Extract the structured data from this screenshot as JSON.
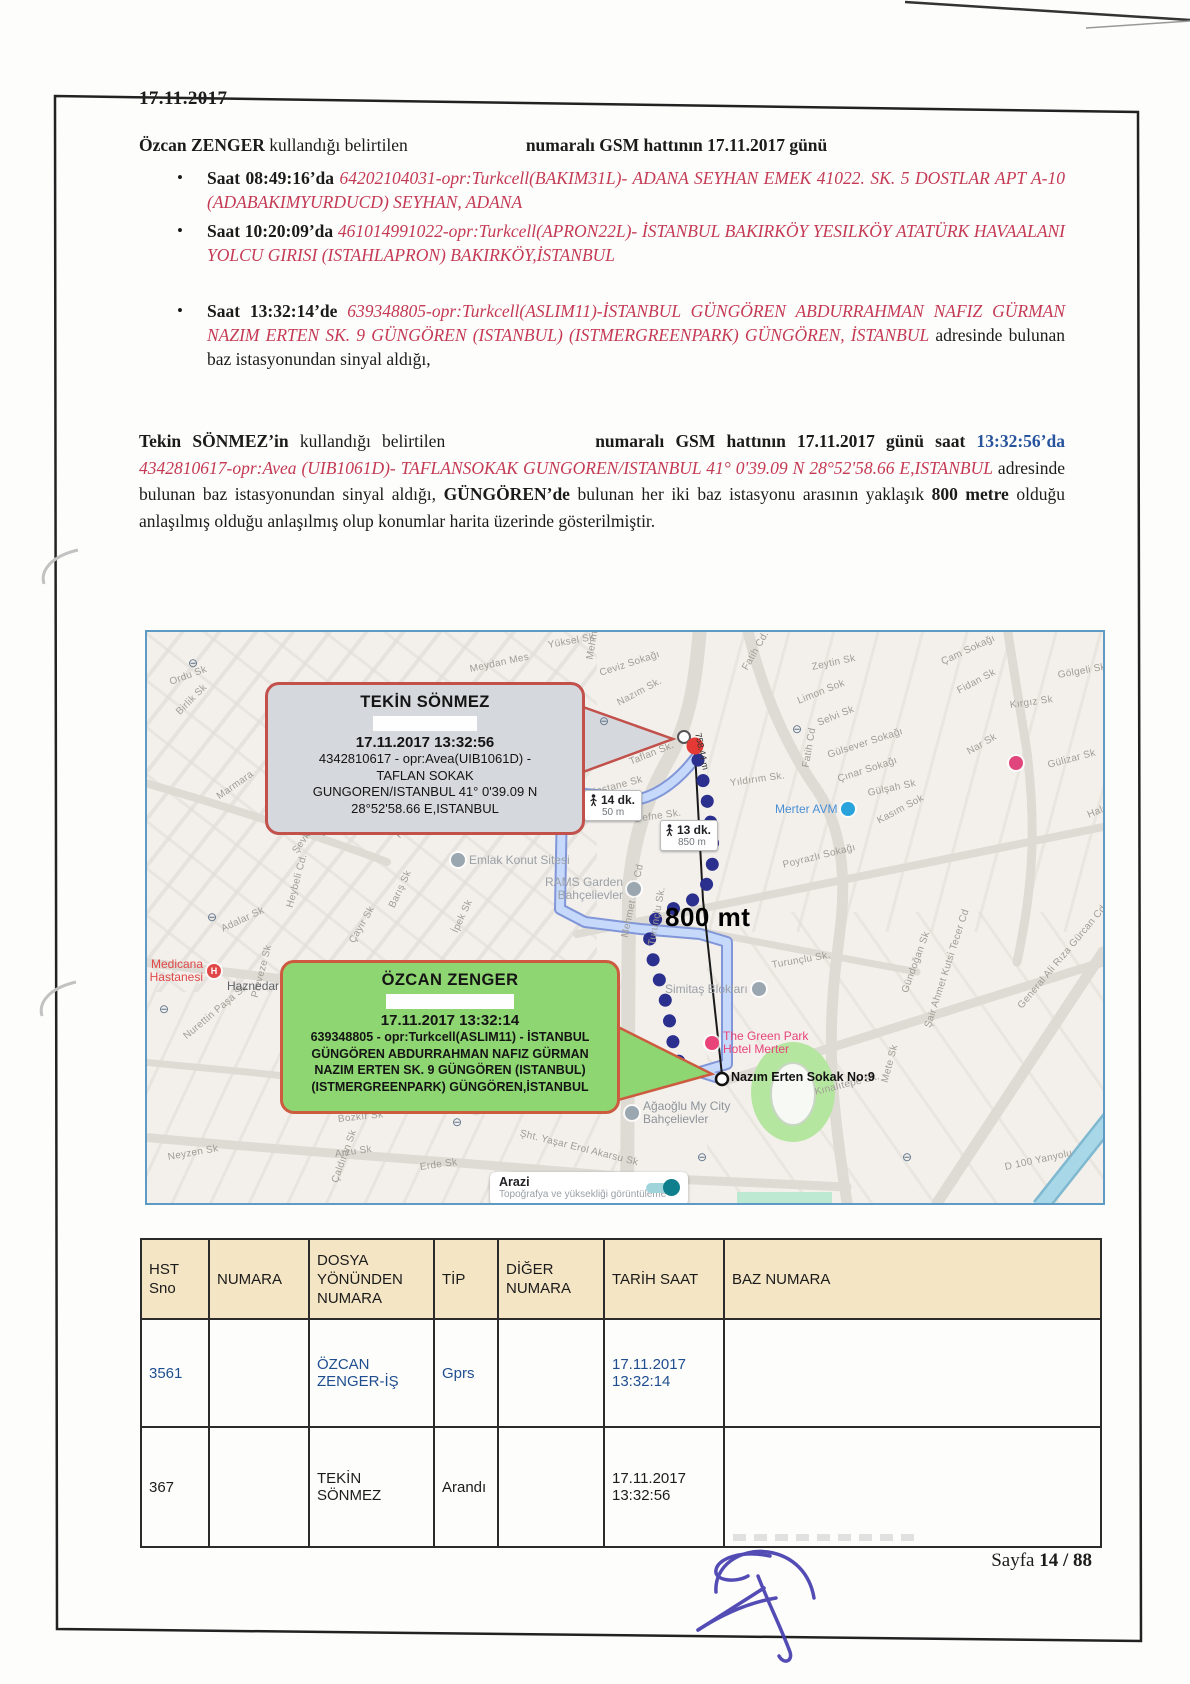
{
  "page": {
    "date": "17.11.2017",
    "footer_prefix": "Sayfa ",
    "footer_page": "14 / 88"
  },
  "ozcan_para": {
    "name": "Özcan ZENGER",
    "mid": " kullandığı belirtilen",
    "tail": "numaralı GSM hattının 17.11.2017 günü"
  },
  "bullets": [
    {
      "time": "Saat 08:49:16’da ",
      "detail": "64202104031-opr:Turkcell(BAKIM31L)- ADANA SEYHAN EMEK 41022. SK. 5 DOSTLAR APT A-10 (ADABAKIMYURDUCD) SEYHAN, ADANA",
      "suffix": ""
    },
    {
      "time": "Saat 10:20:09’da ",
      "detail": "461014991022-opr:Turkcell(APRON22L)- İSTANBUL BAKIRKÖY YESILKÖY ATATÜRK HAVAALANI YOLCU GIRISI (ISTAHLAPRON) BAKIRKÖY,İSTANBUL",
      "suffix": ""
    },
    {
      "time": "Saat 13:32:14’de ",
      "detail": "639348805-opr:Turkcell(ASLIM11)-İSTANBUL GÜNGÖREN ABDURRAHMAN NAFIZ GÜRMAN NAZIM ERTEN SK. 9 GÜNGÖREN (ISTANBUL) (ISTMERGREENPARK) GÜNGÖREN, İSTANBUL",
      "suffix": " adresinde bulunan baz istasyonundan sinyal aldığı,"
    }
  ],
  "tekin_para": {
    "name": "Tekin SÖNMEZ’in",
    "mid": " kullandığı belirtilen",
    "bold1": "numaralı GSM hattının 17.11.2017 günü saat ",
    "time_blue": "13:32:56’da ",
    "red": "4342810617-opr:Avea (UIB1061D)- TAFLANSOKAK GUNGOREN/ISTANBUL 41° 0'39.09 N 28°52'58.66 E,ISTANBUL",
    "normal1": " adresinde bulunan baz istasyonundan sinyal aldığı, ",
    "bold2": "GÜNGÖREN’de",
    "normal2": " bulunan her iki baz istasyonu arasının yaklaşık ",
    "bold3": "800 metre",
    "normal3": " olduğu anlaşılmış olduğu anlaşılmış olup konumlar harita üzerinde gösterilmiştir."
  },
  "map": {
    "callouts": {
      "tekin": {
        "title": "TEKİN SÖNMEZ",
        "datetime": "17.11.2017 13:32:56",
        "line1": "4342810617 - opr:Avea(UIB1061D) -",
        "line2": "TAFLAN SOKAK",
        "line3": "GUNGOREN/ISTANBUL   41° 0'39.09 N",
        "line4": "28°52'58.66 E,ISTANBUL"
      },
      "ozcan": {
        "title": "ÖZCAN ZENGER",
        "datetime": "17.11.2017 13:32:14",
        "line1": "639348805 - opr:Turkcell(ASLIM11) - İSTANBUL",
        "line2": "GÜNGÖREN ABDURRAHMAN NAFIZ GÜRMAN",
        "line3": "NAZIM ERTEN SK. 9 GÜNGÖREN (ISTANBUL)",
        "line4": "(ISTMERGREENPARK) GÜNGÖREN,İSTANBUL"
      }
    },
    "distance_big": "800 mt",
    "measure_label": "758.44 m",
    "route_badge_1": {
      "duration": "13 dk.",
      "distance": "850 m"
    },
    "route_badge_2": {
      "duration": "14 dk.",
      "distance": "50 m"
    },
    "destination_label": "Nazım Erten Sokak No:9",
    "terrain": {
      "title": "Arazi",
      "subtitle": "Topoğrafya ve yüksekliği görüntüleme"
    },
    "colors": {
      "route": "#2b2f8e",
      "route_light": "#c6d9fb",
      "marker_red": "#e53935",
      "callout_gray": "#d5d8dc",
      "callout_green": "#8ed672",
      "border_red": "#c2504b"
    },
    "pois": [
      {
        "t": "Merter AVM",
        "x": 628,
        "y": 170,
        "side": "r",
        "c": "#4a8fd4",
        "ic": "#29a3dc"
      },
      {
        "t": "Emlak Konut Sitesi",
        "x": 304,
        "y": 221,
        "side": "l",
        "c": "#9aa0a6",
        "ic": "#9aa7b0"
      },
      {
        "t": "RAMS Garden Bahçelievler",
        "x": 388,
        "y": 244,
        "side": "r",
        "c": "#9aa0a6",
        "ic": "#9aa7b0",
        "w": 88,
        "ta": "right"
      },
      {
        "t": "Simitaş Blokları",
        "x": 518,
        "y": 350,
        "side": "r",
        "c": "#9aa0a6",
        "ic": "#9aa7b0"
      },
      {
        "t": "The Green Park Hotel Merter",
        "x": 558,
        "y": 398,
        "side": "l",
        "c": "#e8447a",
        "ic": "#e8447a",
        "w": 112
      },
      {
        "t": "Ağaoğlu My City Bahçelievler",
        "x": 478,
        "y": 468,
        "side": "l",
        "c": "#8d9399",
        "ic": "#9aa7b0",
        "w": 118
      },
      {
        "t": "Medicana Hastanesi",
        "x": -14,
        "y": 326,
        "side": "r",
        "c": "#e04848",
        "ic": "#e04848",
        "letter": "H",
        "w": 70,
        "ta": "right"
      },
      {
        "t": "Haznedar",
        "x": 80,
        "y": 348,
        "side": "r",
        "c": "#5f6368",
        "ic": "#98a4ae",
        "sq": 1
      },
      {
        "t": "",
        "x": 862,
        "y": 124,
        "side": "l",
        "c": "#000000",
        "ic": "#e0457b"
      }
    ],
    "streets": [
      {
        "t": "Yüksel Sk",
        "x": 401,
        "y": 8,
        "r": -10
      },
      {
        "t": "Ceviz Sokağı",
        "x": 453,
        "y": 36,
        "r": -18
      },
      {
        "t": "Nazım Sk.",
        "x": 471,
        "y": 66,
        "r": -28
      },
      {
        "t": "Meydan Mes",
        "x": 323,
        "y": 32,
        "r": -12
      },
      {
        "t": "Mehmet Akif Cd",
        "x": 443,
        "y": 22,
        "r": -80
      },
      {
        "t": "Fatih Cd.",
        "x": 598,
        "y": 32,
        "r": -60
      },
      {
        "t": "Zeytin Sk",
        "x": 665,
        "y": 30,
        "r": -12
      },
      {
        "t": "Limon Sok",
        "x": 651,
        "y": 64,
        "r": -22
      },
      {
        "t": "Selvi Sk",
        "x": 671,
        "y": 86,
        "r": -22
      },
      {
        "t": "Gülsever Sokağı",
        "x": 681,
        "y": 118,
        "r": -18
      },
      {
        "t": "Çınar Sokağı",
        "x": 691,
        "y": 142,
        "r": -18
      },
      {
        "t": "Fatih Cd",
        "x": 659,
        "y": 130,
        "r": -80
      },
      {
        "t": "Gülşah Sk",
        "x": 721,
        "y": 156,
        "r": -12
      },
      {
        "t": "Kasım Sok",
        "x": 731,
        "y": 184,
        "r": -28
      },
      {
        "t": "Çam Sokağı",
        "x": 795,
        "y": 25,
        "r": -25
      },
      {
        "t": "Gölgeli Sk",
        "x": 911,
        "y": 38,
        "r": -10
      },
      {
        "t": "Fidan Sk",
        "x": 811,
        "y": 54,
        "r": -28
      },
      {
        "t": "Kırgız Sk",
        "x": 863,
        "y": 68,
        "r": -8
      },
      {
        "t": "Nar Sk",
        "x": 821,
        "y": 115,
        "r": -30
      },
      {
        "t": "Gülizar Sk",
        "x": 901,
        "y": 128,
        "r": -15
      },
      {
        "t": "Haldun Tan",
        "x": 941,
        "y": 178,
        "r": -22
      },
      {
        "t": "Taflan Sk.",
        "x": 483,
        "y": 125,
        "r": -22
      },
      {
        "t": "Kestane Sk",
        "x": 443,
        "y": 156,
        "r": -15
      },
      {
        "t": "Defne Sk.",
        "x": 488,
        "y": 182,
        "r": -8
      },
      {
        "t": "Yıldırım Sk.",
        "x": 583,
        "y": 146,
        "r": -8
      },
      {
        "t": "Poyrazlı Sokağı",
        "x": 636,
        "y": 228,
        "r": -14
      },
      {
        "t": "Ordu Sk",
        "x": 23,
        "y": 45,
        "r": -20
      },
      {
        "t": "Birlik Sk",
        "x": 31,
        "y": 76,
        "r": -45
      },
      {
        "t": "Marmara",
        "x": 71,
        "y": 160,
        "r": -35
      },
      {
        "t": "Ahmtar Sk",
        "x": 193,
        "y": 165,
        "r": -70
      },
      {
        "t": "Köşkler Sk",
        "x": 175,
        "y": 198,
        "r": -55
      },
      {
        "t": "Şevket Dağ Cd.",
        "x": 148,
        "y": 215,
        "r": -55
      },
      {
        "t": "Adnan Kahveci Blv",
        "x": 251,
        "y": 200,
        "r": -72
      },
      {
        "t": "Barış Sk",
        "x": 245,
        "y": 270,
        "r": -65
      },
      {
        "t": "İpek Sk",
        "x": 308,
        "y": 295,
        "r": -65
      },
      {
        "t": "Çayır Sk",
        "x": 205,
        "y": 305,
        "r": -60
      },
      {
        "t": "Heybeli Cd.",
        "x": 143,
        "y": 270,
        "r": -75
      },
      {
        "t": "Adalar Sk",
        "x": 75,
        "y": 292,
        "r": -25
      },
      {
        "t": "Preveze Sk",
        "x": 108,
        "y": 360,
        "r": -75
      },
      {
        "t": "Nurettin Paşa Sk",
        "x": 38,
        "y": 400,
        "r": -40
      },
      {
        "t": "Mehmet Akif Cd",
        "x": 478,
        "y": 300,
        "r": -78
      },
      {
        "t": "Turunçlu Sk.",
        "x": 505,
        "y": 308,
        "r": -80
      },
      {
        "t": "Turunçlu Sk.",
        "x": 625,
        "y": 328,
        "r": -10
      },
      {
        "t": "Bozkır Sk",
        "x": 191,
        "y": 482,
        "r": -6
      },
      {
        "t": "Arzu Sk",
        "x": 188,
        "y": 517,
        "r": -8
      },
      {
        "t": "Şht. Yaşar Erol Akarsu Sk",
        "x": 373,
        "y": 496,
        "r": 14
      },
      {
        "t": "Kınalıtepe Sk.",
        "x": 668,
        "y": 455,
        "r": -14
      },
      {
        "t": "Gündoğan Sk",
        "x": 758,
        "y": 355,
        "r": -70
      },
      {
        "t": "Şair Ahmet Kutsi Tecer Cd",
        "x": 781,
        "y": 390,
        "r": -72
      },
      {
        "t": "General Ali Rıza Gürcan Cd.",
        "x": 873,
        "y": 370,
        "r": -50
      },
      {
        "t": "Mete Sk",
        "x": 738,
        "y": 445,
        "r": -75
      },
      {
        "t": "D 100 Yanyolu",
        "x": 858,
        "y": 530,
        "r": -12
      },
      {
        "t": "Erde Sk",
        "x": 273,
        "y": 530,
        "r": -8
      },
      {
        "t": "Neyzen Sk",
        "x": 21,
        "y": 520,
        "r": -10
      },
      {
        "t": "Çaldıran Sk",
        "x": 188,
        "y": 545,
        "r": -70
      }
    ],
    "transit": [
      [
        41,
        24
      ],
      [
        452,
        82
      ],
      [
        645,
        90
      ],
      [
        60,
        278
      ],
      [
        12,
        370
      ],
      [
        305,
        483
      ],
      [
        550,
        518
      ],
      [
        755,
        518
      ]
    ]
  },
  "table": {
    "headers": [
      "HST Sno",
      "NUMARA",
      "DOSYA YÖNÜNDEN NUMARA",
      "TİP",
      "DİĞER NUMARA",
      "TARİH SAAT",
      "BAZ NUMARA"
    ],
    "rows": [
      {
        "hst": "3561",
        "numara": "",
        "dosya": "ÖZCAN ZENGER-İŞ",
        "tip": "Gprs",
        "diger": "",
        "tarih": "17.11.2017 13:32:14",
        "baz": ""
      },
      {
        "hst": "367",
        "numara": "",
        "dosya": "TEKİN SÖNMEZ",
        "tip": "Arandı",
        "diger": "",
        "tarih": "17.11.2017 13:32:56",
        "baz": ""
      }
    ]
  }
}
